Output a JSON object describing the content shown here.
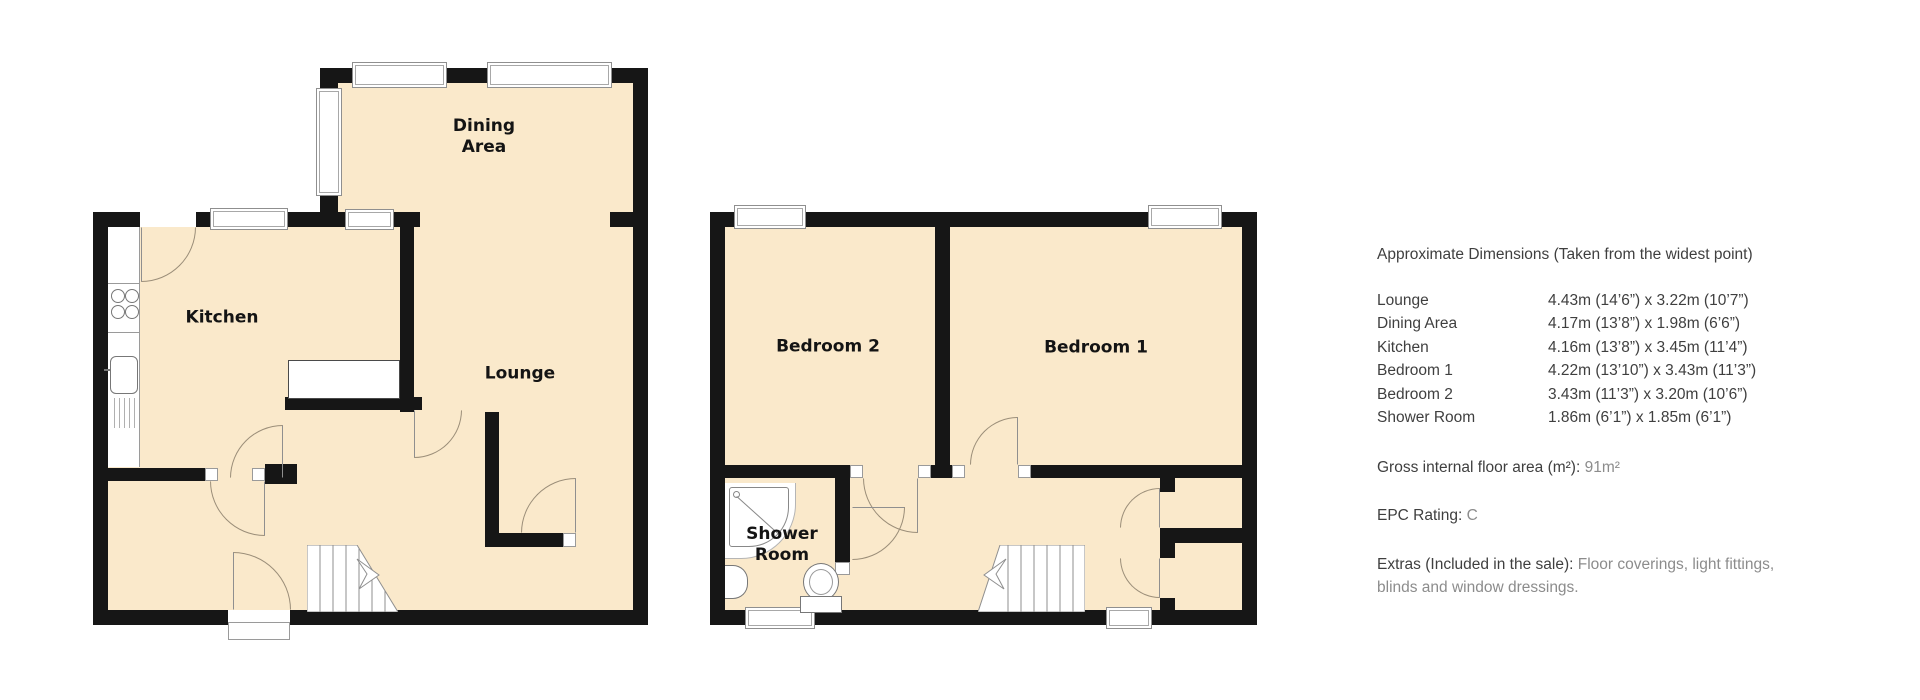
{
  "colors": {
    "room_fill": "#FAE9CB",
    "wall": "#161616",
    "door_arc": "#9B8E79",
    "text": "#3F3F3F",
    "text_light": "#8C8C8C"
  },
  "ground_floor": {
    "rooms": [
      {
        "name": "dining-area",
        "label": "Dining Area"
      },
      {
        "name": "kitchen",
        "label": "Kitchen"
      },
      {
        "name": "lounge",
        "label": "Lounge"
      }
    ]
  },
  "first_floor": {
    "rooms": [
      {
        "name": "bedroom-2",
        "label": "Bedroom 2"
      },
      {
        "name": "bedroom-1",
        "label": "Bedroom 1"
      },
      {
        "name": "shower-room",
        "label": "Shower Room"
      }
    ]
  },
  "info_panel": {
    "heading": "Approximate Dimensions (Taken from the widest point)",
    "dimensions": [
      {
        "room": "Lounge",
        "size": "4.43m (14’6”) x 3.22m (10’7”)"
      },
      {
        "room": "Dining Area",
        "size": "4.17m (13’8”) x 1.98m (6’6”)"
      },
      {
        "room": "Kitchen",
        "size": "4.16m (13’8”) x 3.45m (11’4”)"
      },
      {
        "room": "Bedroom 1",
        "size": "4.22m (13’10”) x 3.43m (11’3”)"
      },
      {
        "room": "Bedroom 2",
        "size": "3.43m (11’3”) x 3.20m (10’6”)"
      },
      {
        "room": "Shower Room",
        "size": "1.86m (6’1”) x 1.85m (6’1”)"
      }
    ],
    "gross_area_label": "Gross internal floor area (m²): ",
    "gross_area_value": "91m²",
    "epc_label": "EPC Rating: ",
    "epc_value": "C",
    "extras_label": "Extras (Included in the sale): ",
    "extras_value": "Floor coverings, light fittings, blinds and window dressings."
  }
}
